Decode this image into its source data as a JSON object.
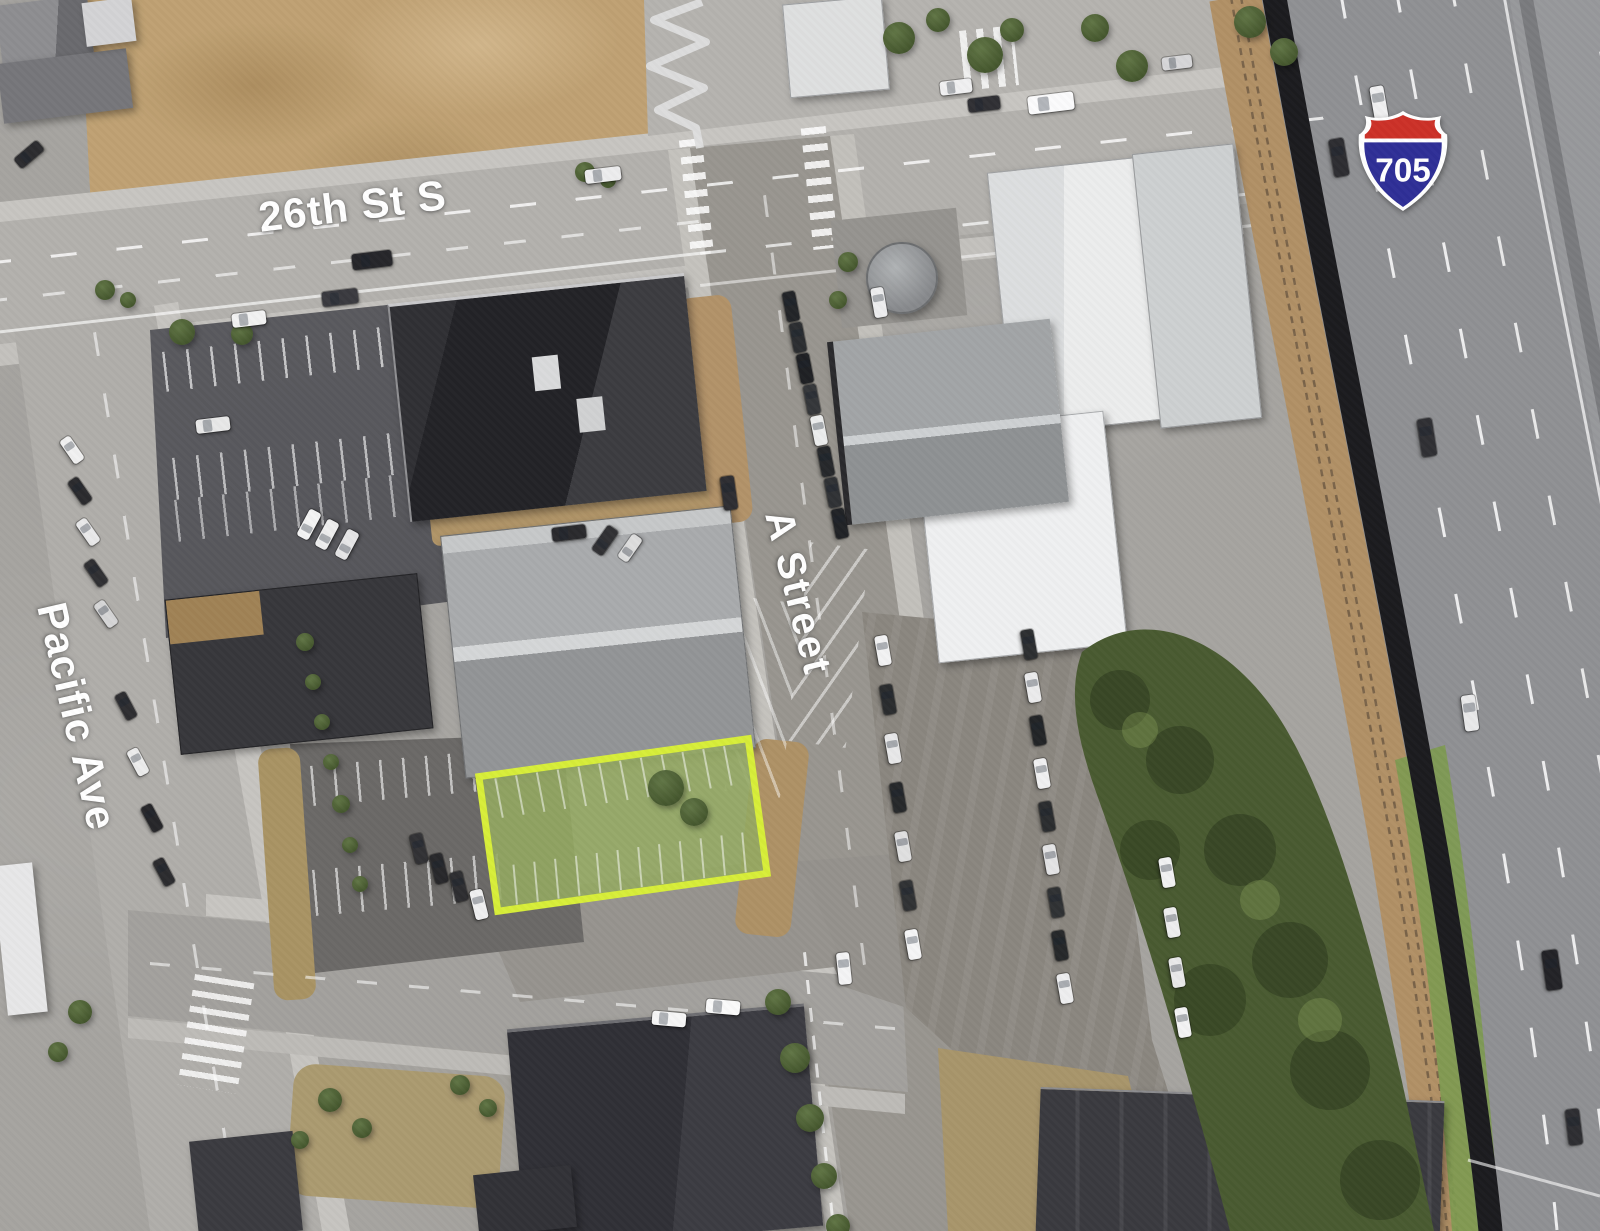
{
  "title": "Aerial site map",
  "map": {
    "labels": {
      "street_26th": "26th St S",
      "street_a": "A Street",
      "street_pacific": "Pacific Ave",
      "interstate_number": "705"
    },
    "shield": {
      "type": "Interstate",
      "number": "705",
      "red": "#cc3128",
      "blue": "#2f2f96",
      "white": "#ffffff"
    },
    "parcel": {
      "name": "Highlighted parcel",
      "outline_color": "#d7ee39",
      "fill_color": "#94aa62"
    },
    "label_color": "#ffffff"
  }
}
